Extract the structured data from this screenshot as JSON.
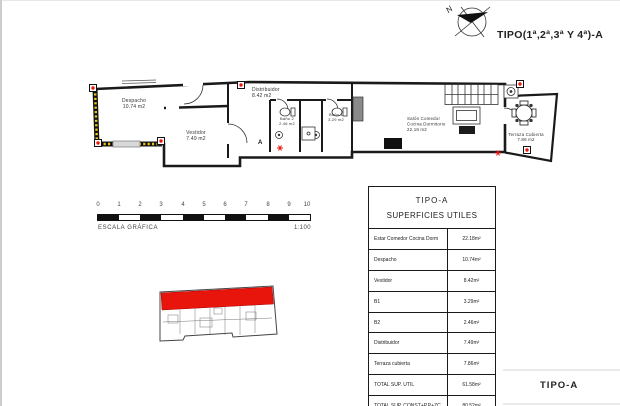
{
  "page": {
    "title": "TIPO(1ª,2ª,3ª Y 4ª)-A",
    "type_label": "TIPO-A",
    "compass_label": "N"
  },
  "plan": {
    "rooms": {
      "despacho": {
        "name": "Despacho",
        "area": "10.74 m2"
      },
      "vestidor": {
        "name": "Vestidor",
        "area": "7.49 m2"
      },
      "distribuidor": {
        "name": "Distribuidor",
        "area": "8.42 m2"
      },
      "bano2": {
        "name": "Baño 2",
        "area": "2.46 m2"
      },
      "bano1": {
        "name": "Baño 1",
        "area": "3.29 m2"
      },
      "salon": {
        "line1": "Salón Comedor",
        "line2": "Cocina Dormitorio",
        "area": "22.18 m2"
      },
      "terraza": {
        "name": "Terraza Cubierta",
        "area": "7.86 m2"
      }
    },
    "section_marker": "A"
  },
  "scale": {
    "ticks": [
      "0",
      "1",
      "2",
      "3",
      "4",
      "5",
      "6",
      "7",
      "8",
      "9",
      "10"
    ],
    "label": "ESCALA GRÁFICA",
    "ratio": "1:100"
  },
  "table": {
    "title": "TIPO-A",
    "subtitle": "SUPERFICIES UTILES",
    "rows": [
      {
        "label": "Estar Comedor Cocina Dorm",
        "value": "22.18m²"
      },
      {
        "label": "Despacho",
        "value": "10.74m²"
      },
      {
        "label": "Vestidor",
        "value": "8.42m²"
      },
      {
        "label": "B1",
        "value": "3.29m²"
      },
      {
        "label": "B2",
        "value": "2.46m²"
      },
      {
        "label": "Distribuidor",
        "value": "7.49m²"
      },
      {
        "label": "Terraza cubierta",
        "value": "7.86m²"
      },
      {
        "label": "TOTAL SUP. UTIL",
        "value": "61.58m²"
      },
      {
        "label": "TOTAL SUP. CONST+P.P+ZC",
        "value": "80.52m²"
      }
    ]
  },
  "colors": {
    "highlight": "#e8150d",
    "wall": "#1a1a1a",
    "hatch": "#e6c619"
  }
}
